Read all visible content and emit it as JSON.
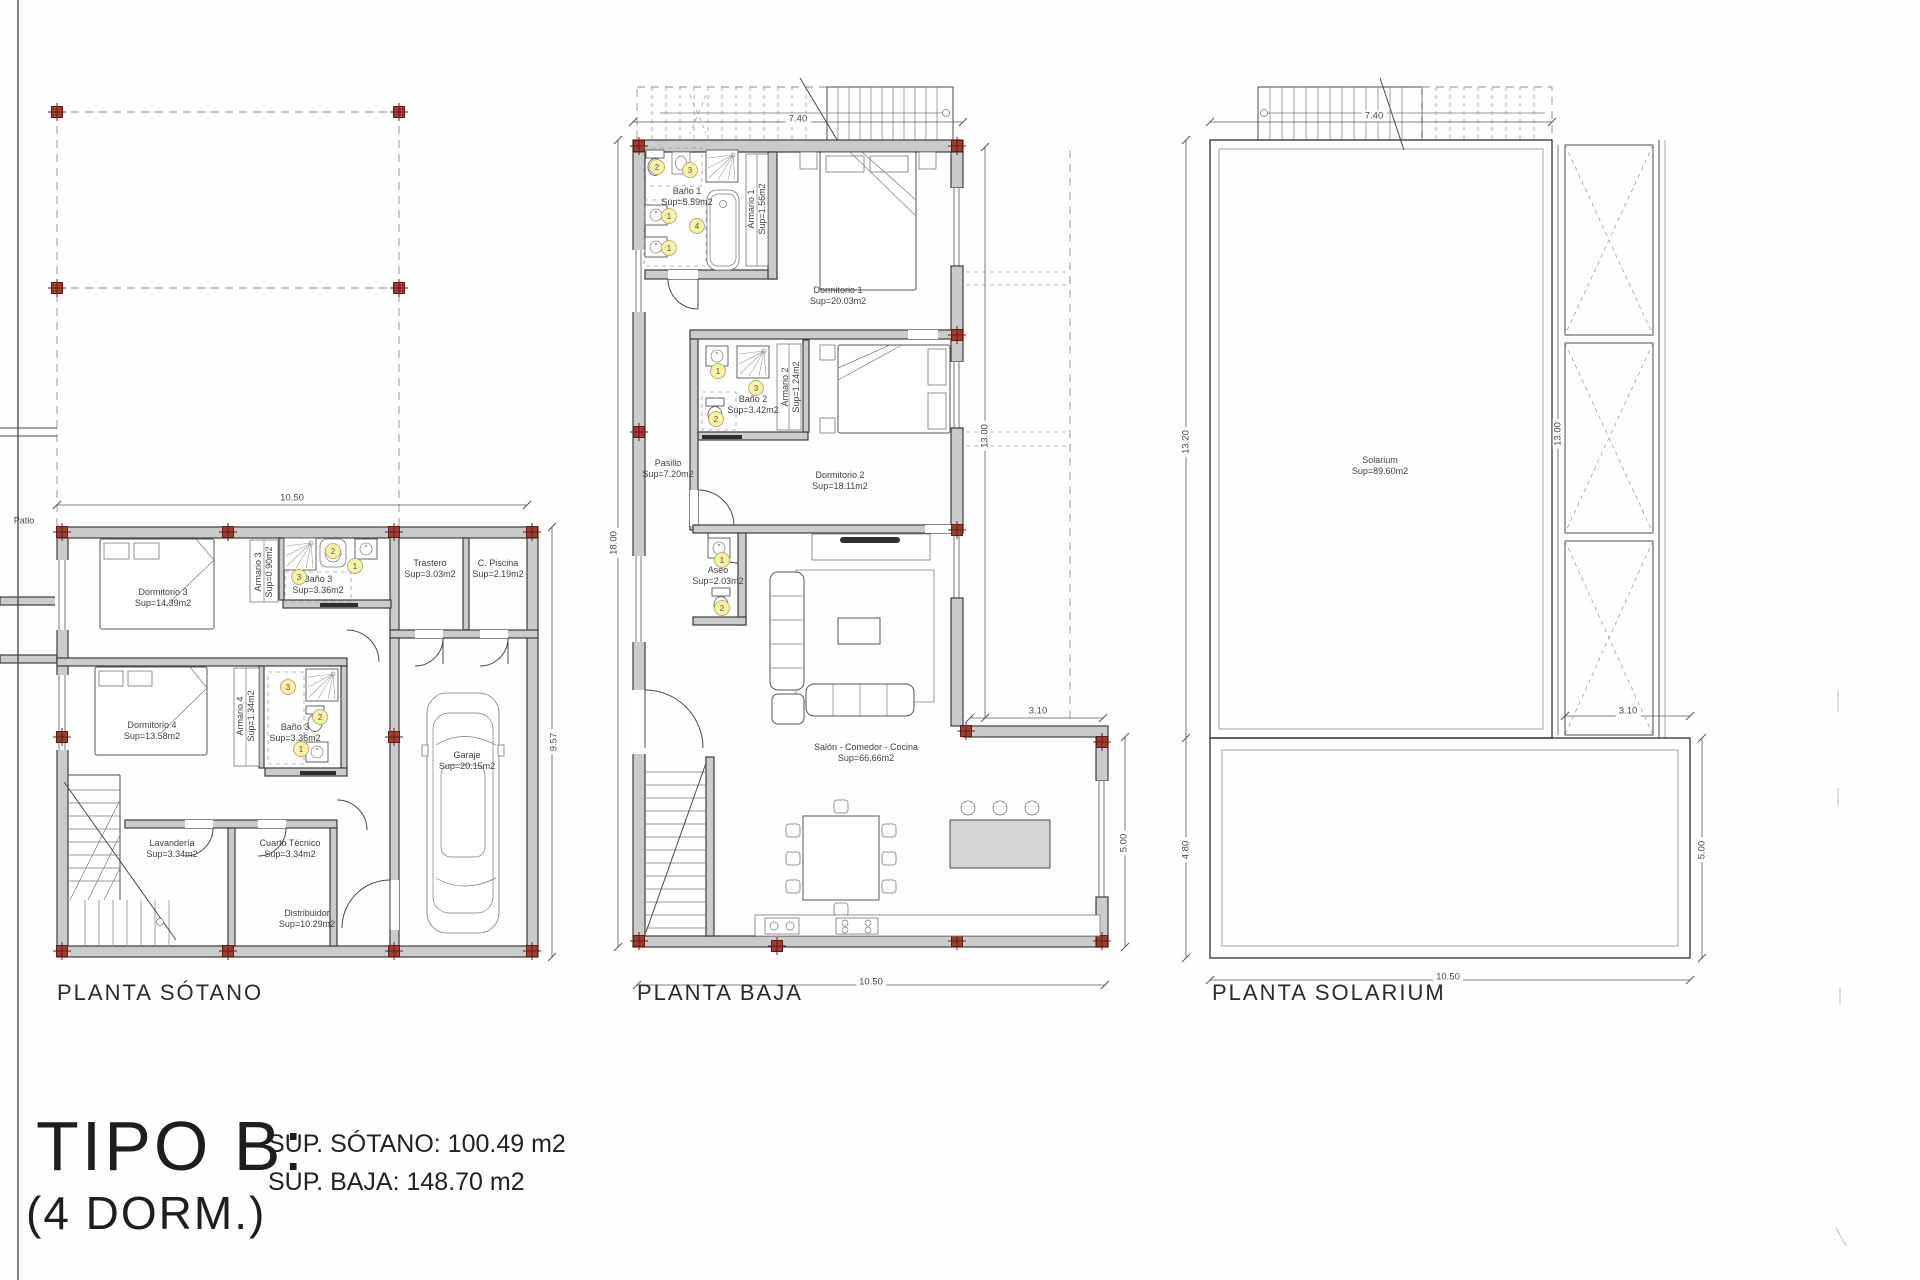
{
  "palette": {
    "wall_fill": "#cbcbcb",
    "line": "#3c3c3c",
    "column_marker": "#a23c30",
    "fixture_badge": "#f7f2a4",
    "background": "#fefefe"
  },
  "title_block": {
    "type_label": "TIPO B:",
    "dorm_label": "(4 DORM.)",
    "sup_sotano": "SUP. SÓTANO: 100.49 m2",
    "sup_baja": "SUP. BAJA: 148.70 m2"
  },
  "badges": {
    "b1": "1",
    "b2": "2",
    "b3": "3",
    "b4": "4"
  },
  "plans": {
    "sotano": {
      "title": "PLANTA SÓTANO",
      "side_label": "Patio",
      "rooms": [
        {
          "name": "Dormitorio 3",
          "sup": "Sup=14.39m2"
        },
        {
          "name": "Armario 3",
          "sup": "Sup=0.90m2"
        },
        {
          "name": "Baño 3",
          "sup": "Sup=3.36m2"
        },
        {
          "name": "Trastero",
          "sup": "Sup=3.03m2"
        },
        {
          "name": "C. Piscina",
          "sup": "Sup=2.19m2"
        },
        {
          "name": "Dormitorio 4",
          "sup": "Sup=13.58m2"
        },
        {
          "name": "Armario 4",
          "sup": "Sup=1.34m2"
        },
        {
          "name": "Baño 3",
          "sup": "Sup=3.36m2"
        },
        {
          "name": "Lavandería",
          "sup": "Sup=3.34m2"
        },
        {
          "name": "Cuarto Técnico",
          "sup": "Sup=3.34m2"
        },
        {
          "name": "Distribuidor",
          "sup": "Sup=10.29m2"
        },
        {
          "name": "Garaje",
          "sup": "Sup=20.15m2"
        }
      ],
      "dims": {
        "width": "10.50",
        "height": "9.57"
      }
    },
    "baja": {
      "title": "PLANTA BAJA",
      "rooms": [
        {
          "name": "Baño 1",
          "sup": "Sup=5.59m2"
        },
        {
          "name": "Armario 1",
          "sup": "Sup=1.56m2"
        },
        {
          "name": "Dormitorio 1",
          "sup": "Sup=20.03m2"
        },
        {
          "name": "Baño 2",
          "sup": "Sup=3.42m2"
        },
        {
          "name": "Armario 2",
          "sup": "Sup=1.24m2"
        },
        {
          "name": "Dormitorio 2",
          "sup": "Sup=18.11m2"
        },
        {
          "name": "Pasillo",
          "sup": "Sup=7.20m2"
        },
        {
          "name": "Aseo",
          "sup": "Sup=2.03m2"
        },
        {
          "name": "Salón - Comedor - Cocina",
          "sup": "Sup=66.66m2"
        }
      ],
      "dims": {
        "top": "7.40",
        "left": "18.00",
        "right": "13.00",
        "ext": "3.10",
        "terrace": "5.00",
        "bottom": "10.50"
      }
    },
    "solarium": {
      "title": "PLANTA SOLARIUM",
      "rooms": [
        {
          "name": "Solarium",
          "sup": "Sup=89.60m2"
        }
      ],
      "dims": {
        "top": "7.40",
        "left_upper": "13.20",
        "right_upper": "13.00",
        "ext": "3.10",
        "left_lower": "4.80",
        "right_lower": "5.00",
        "bottom": "10.50"
      }
    }
  }
}
